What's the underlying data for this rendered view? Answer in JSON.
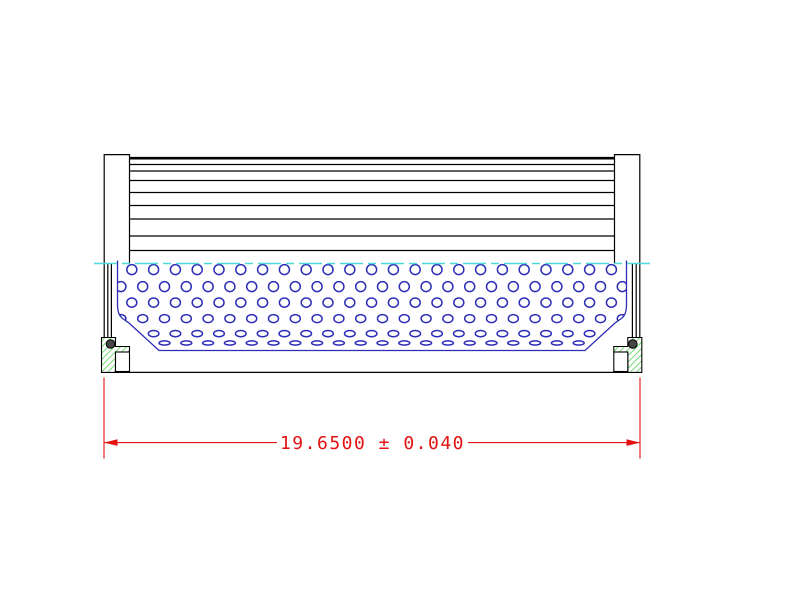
{
  "dimension": {
    "label": "19.6500 ± 0.040",
    "value": "19.6500",
    "plus_minus": "±",
    "tolerance": "0.040"
  },
  "colors": {
    "outline_black": "#000000",
    "dimension_red": "#e31212",
    "perforation_blue": "#2d2db8",
    "centerline_cyan": "#4fd8d8",
    "seal_hatch_green": "#5cd65c",
    "oring_gray": "#474747",
    "background": "#ffffff"
  }
}
